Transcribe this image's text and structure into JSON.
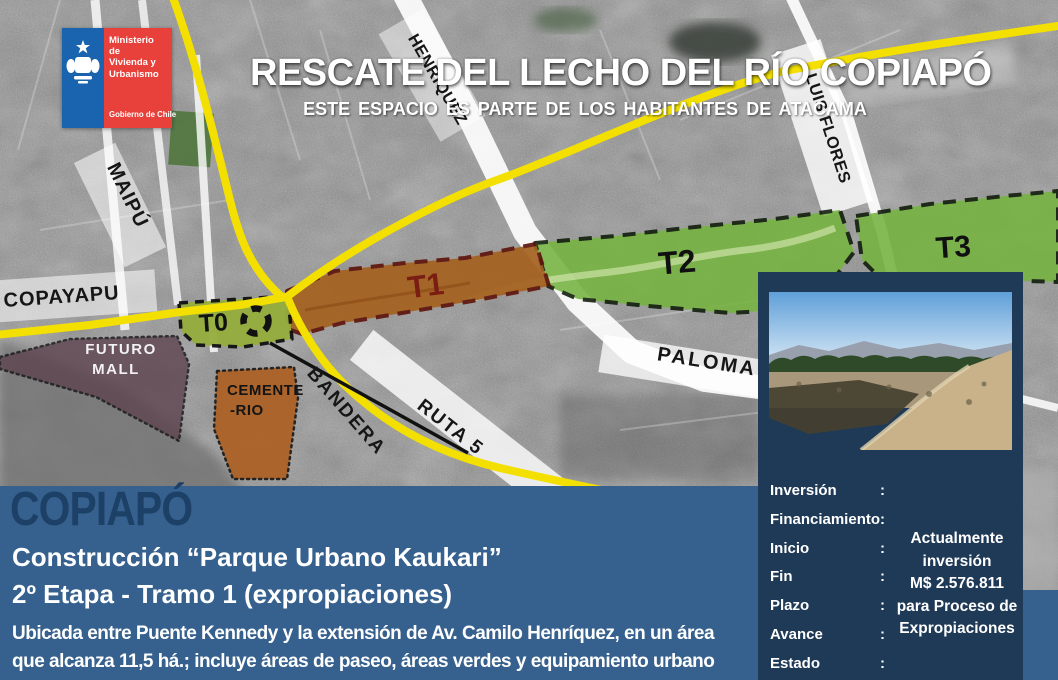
{
  "logo": {
    "ministry_lines": [
      "Ministerio de",
      "Vivienda y",
      "Urbanismo"
    ],
    "government": "Gobierno de Chile",
    "colors": {
      "blue": "#1a63ae",
      "red": "#e8403a"
    }
  },
  "header": {
    "title": "RESCATE DEL LECHO DEL RÍO COPIAPÓ",
    "subtitle": "ESTE ESPACIO ES PARTE DE LOS HABITANTES DE ATACAMA"
  },
  "map": {
    "street_labels": {
      "maipu": "MAIPÚ",
      "copayapu": "COPAYAPU",
      "henriquez": "HENRIQUEZ",
      "luis_flores": "LUIS FLORES",
      "paloma": "PALOMA",
      "ruta_5": "RUTA 5",
      "bandera": "BANDERA"
    },
    "zone_labels": {
      "t0": "T0",
      "t1": "T1",
      "t2": "T2",
      "t3": "T3"
    },
    "site_labels": {
      "futuro_mall": [
        "FUTURO",
        "MALL"
      ],
      "cementerio": [
        "CEMENTE",
        "-RIO"
      ]
    },
    "colors": {
      "road_yellow": "#f3e000",
      "tramo_green": "#76b440",
      "tramo_orange": "#a5611f",
      "mall_purple": "#5e4450",
      "cemetery_orange": "#ad5f20"
    }
  },
  "banner": {
    "city": "COPIAPÓ",
    "project_line1": "Construcción “Parque Urbano Kaukari”",
    "project_line2": "2º Etapa - Tramo 1 (expropiaciones)",
    "description_line1": "Ubicada entre Puente Kennedy y la extensión de Av. Camilo Henríquez, en un área",
    "description_line2": "que alcanza  11,5 há.; incluye áreas de paseo, áreas verdes y equipamiento urbano"
  },
  "panel": {
    "separator": ":",
    "rows": [
      {
        "label": "Inversión"
      },
      {
        "label": "Financiamiento"
      },
      {
        "label": "Inicio"
      },
      {
        "label": "Fin"
      },
      {
        "label": "Plazo"
      },
      {
        "label": "Avance"
      },
      {
        "label": "Estado"
      }
    ],
    "highlight_lines": [
      "Actualmente",
      "inversión",
      "M$ 2.576.811",
      "para  Proceso de",
      "Expropiaciones"
    ]
  }
}
